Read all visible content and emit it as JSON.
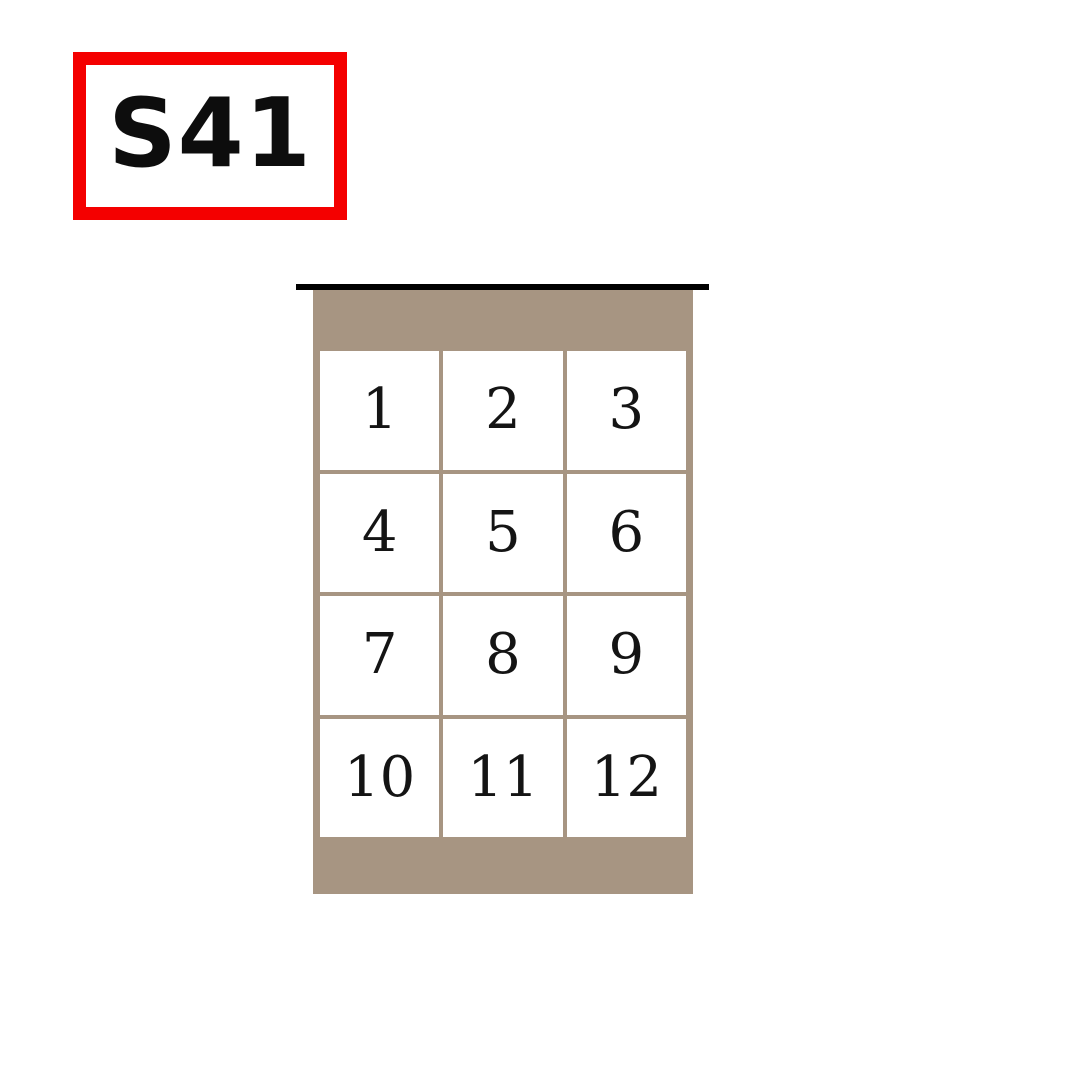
{
  "label_box": {
    "text": "S41"
  },
  "panel": {
    "grid": {
      "rows": 4,
      "cols": 3,
      "cells": [
        "1",
        "2",
        "3",
        "4",
        "5",
        "6",
        "7",
        "8",
        "9",
        "10",
        "11",
        "12"
      ]
    }
  },
  "colors": {
    "page_bg": "#ffffff",
    "label_border": "#f40000",
    "label_text": "#0d0d0d",
    "panel_tan": "#a79582",
    "top_line": "#000000",
    "cell_bg": "#ffffff",
    "cell_text": "#141414"
  }
}
